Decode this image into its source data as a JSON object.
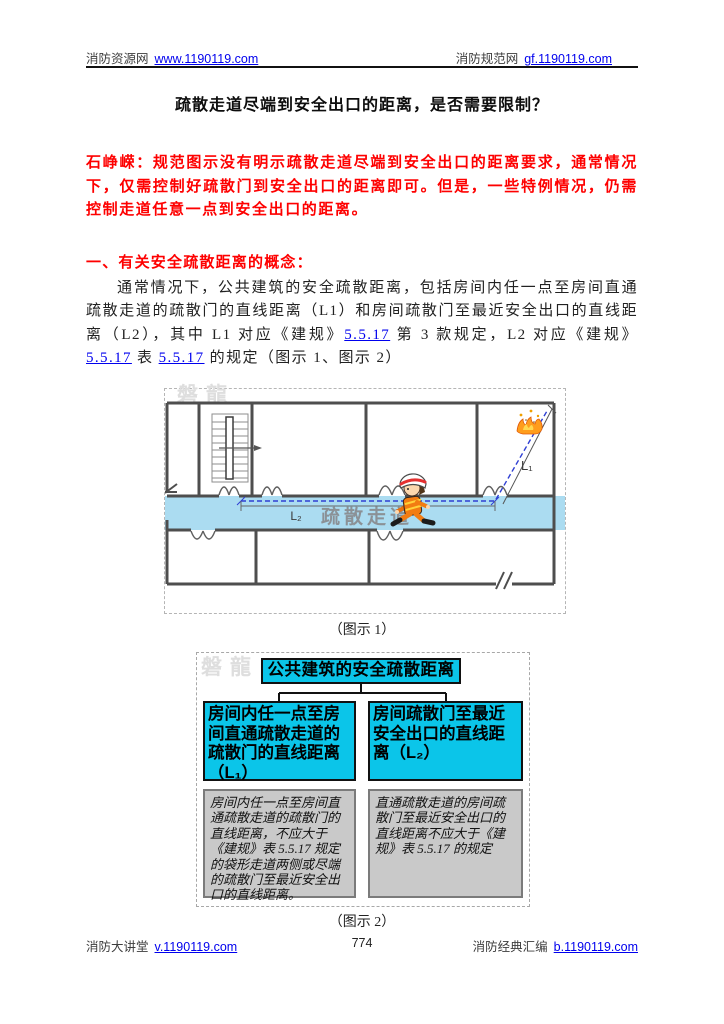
{
  "colors": {
    "accent_red": "#fe0000",
    "link_blue": "#0000ee",
    "cyan_box": "#0bc5e9",
    "corridor_fill": "#abdcf1",
    "gray_box": "#c9c9c9"
  },
  "header": {
    "left_label": "消防资源网",
    "left_link": "www.1190119.com",
    "right_label": "消防规范网",
    "right_link": "gf.1190119.com"
  },
  "title": "疏散走道尽端到安全出口的距离，是否需要限制？",
  "intro": "石峥嵘：规范图示没有明示疏散走道尽端到安全出口的距离要求，通常情况下，仅需控制好疏散门到安全出口的距离即可。但是，一些特例情况，仍需控制走道任意一点到安全出口的距离。",
  "section": {
    "heading": "一、有关安全疏散距离的概念：",
    "para": {
      "seg1": "通常情况下，公共建筑的安全疏散距离，包括房间内任一点至房间直通疏散走道的疏散门的直线距离（L1）和房间疏散门至最近安全出口的直线距离（L2），其中 L1 对应《建规》",
      "link1": "5.5.17",
      "seg2": " 第 3 款规定，L2 对应《建规》",
      "link2": "5.5.17",
      "seg3": " 表 ",
      "link3": "5.5.17",
      "seg4": " 的规定（图示 1、图示 2）"
    }
  },
  "figure1": {
    "caption": "（图示 1）",
    "watermark": "磐龍",
    "corridor_label": "疏散走道",
    "l1": "L₁",
    "l2": "L₂"
  },
  "figure2": {
    "caption": "（图示 2）",
    "watermark": "磐龍",
    "root": "公共建筑的安全疏散距离",
    "branch_left": "房间内任一点至房间直通疏散走道的疏散门的直线距离（L₁）",
    "branch_right": "房间疏散门至最近安全出口的直线距离（L₂）",
    "note_left": "房间内任一点至房间直通疏散走道的疏散门的直线距离，不应大于《建规》表 5.5.17 规定的袋形走道两侧或尽端的疏散门至最近安全出口的直线距离。",
    "note_right": "直通疏散走道的房间疏散门至最近安全出口的直线距离不应大于《建规》表 5.5.17 的规定"
  },
  "footer": {
    "left_label": "消防大讲堂",
    "left_link": "v.1190119.com",
    "page_number": "774",
    "right_label": "消防经典汇编",
    "right_link": "b.1190119.com"
  }
}
